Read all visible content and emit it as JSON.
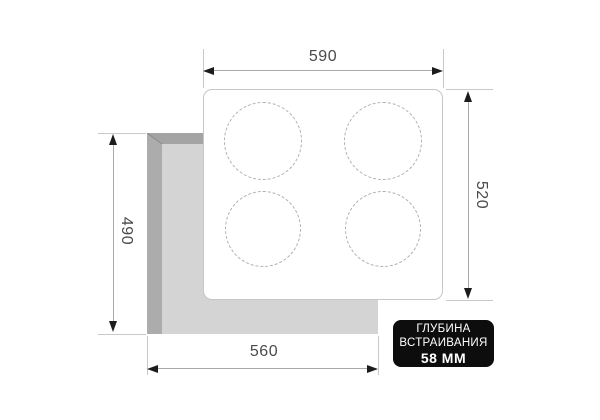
{
  "diagram_title": "built-in cooktop cutout dimensions",
  "dimensions": {
    "top": {
      "value": "590"
    },
    "right": {
      "value": "520"
    },
    "left": {
      "value": "490"
    },
    "bottom": {
      "value": "560"
    }
  },
  "badge": {
    "line1": "ГЛУБИНА",
    "line2": "ВСТРАИВАНИЯ",
    "line3": "58 ММ"
  },
  "colors": {
    "background": "#ffffff",
    "cutout_fill": "#d4d4d4",
    "cutout_edge_dark": "#a6a6a6",
    "cutout_seam": "#8a8a8a",
    "panel_border": "#c6c6c6",
    "burner_dash": "#b0b0b0",
    "dimension_line": "#a9a9a9",
    "extension_line": "#c9c9c9",
    "arrow": "#1c1c1c",
    "dimension_text": "#4a4a4a",
    "badge_bg": "#0d0d0d",
    "badge_text": "#ffffff"
  }
}
